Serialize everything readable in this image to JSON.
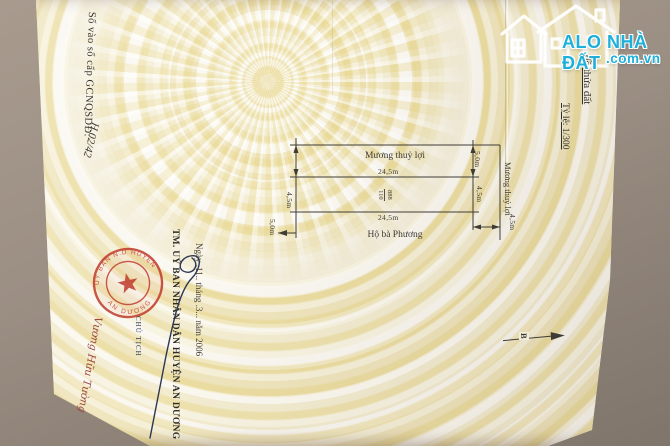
{
  "watermark": {
    "brand": "ALO NHÀ ĐẤT",
    "domain": ".com.vn",
    "accent": "#1db0da"
  },
  "registry_note": {
    "printed": "Số vào sổ cấp GCNQSDĐ:",
    "handwritten": "H.02/42"
  },
  "map_header": {
    "title": "đồ thửa đất",
    "scale": "Tỷ lệ: 1/300"
  },
  "diagram": {
    "canal_top_label": "Mương thuỷ lợi",
    "canal_right_label": "Mương thuỷ lợi",
    "neighbor_label": "Hộ bà Phương",
    "parcel": {
      "number": "888",
      "area": "110"
    },
    "dims": {
      "top": "24,5m",
      "bottom": "24,5m",
      "left": "4,5m",
      "bottom_left": "5,0m",
      "right_top": "5,0m",
      "right_mid": "4,5m",
      "right_bottom": "4,5m"
    },
    "north_label": "B"
  },
  "signature_block": {
    "date_line": "Ngày .11.. tháng .3... năm 2006",
    "authority": "TM. UỶ BAN NHÂN DÂN HUYỆN AN DƯƠNG",
    "role": "CHỦ TỊCH",
    "signer_name": "Vương Hữu Tường"
  },
  "stamp": {
    "arc_top": "UỶ BAN N.D HUYỆN",
    "arc_bottom": "AN DƯƠNG",
    "color": "#c03a2b"
  }
}
